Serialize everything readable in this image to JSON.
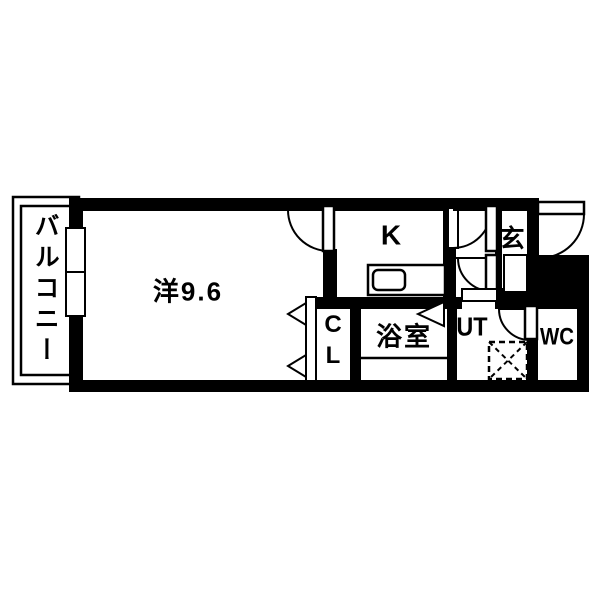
{
  "floorplan": {
    "rooms": {
      "balcony": "バルコニー",
      "living": "洋9.6",
      "kitchen": "K",
      "entrance": "玄",
      "closet_lines": [
        "C",
        "L"
      ],
      "bathroom": "浴室",
      "utility": "UT",
      "toilet": "WC"
    },
    "colors": {
      "wall": "#000000",
      "background": "#ffffff",
      "line": "#000000"
    }
  }
}
